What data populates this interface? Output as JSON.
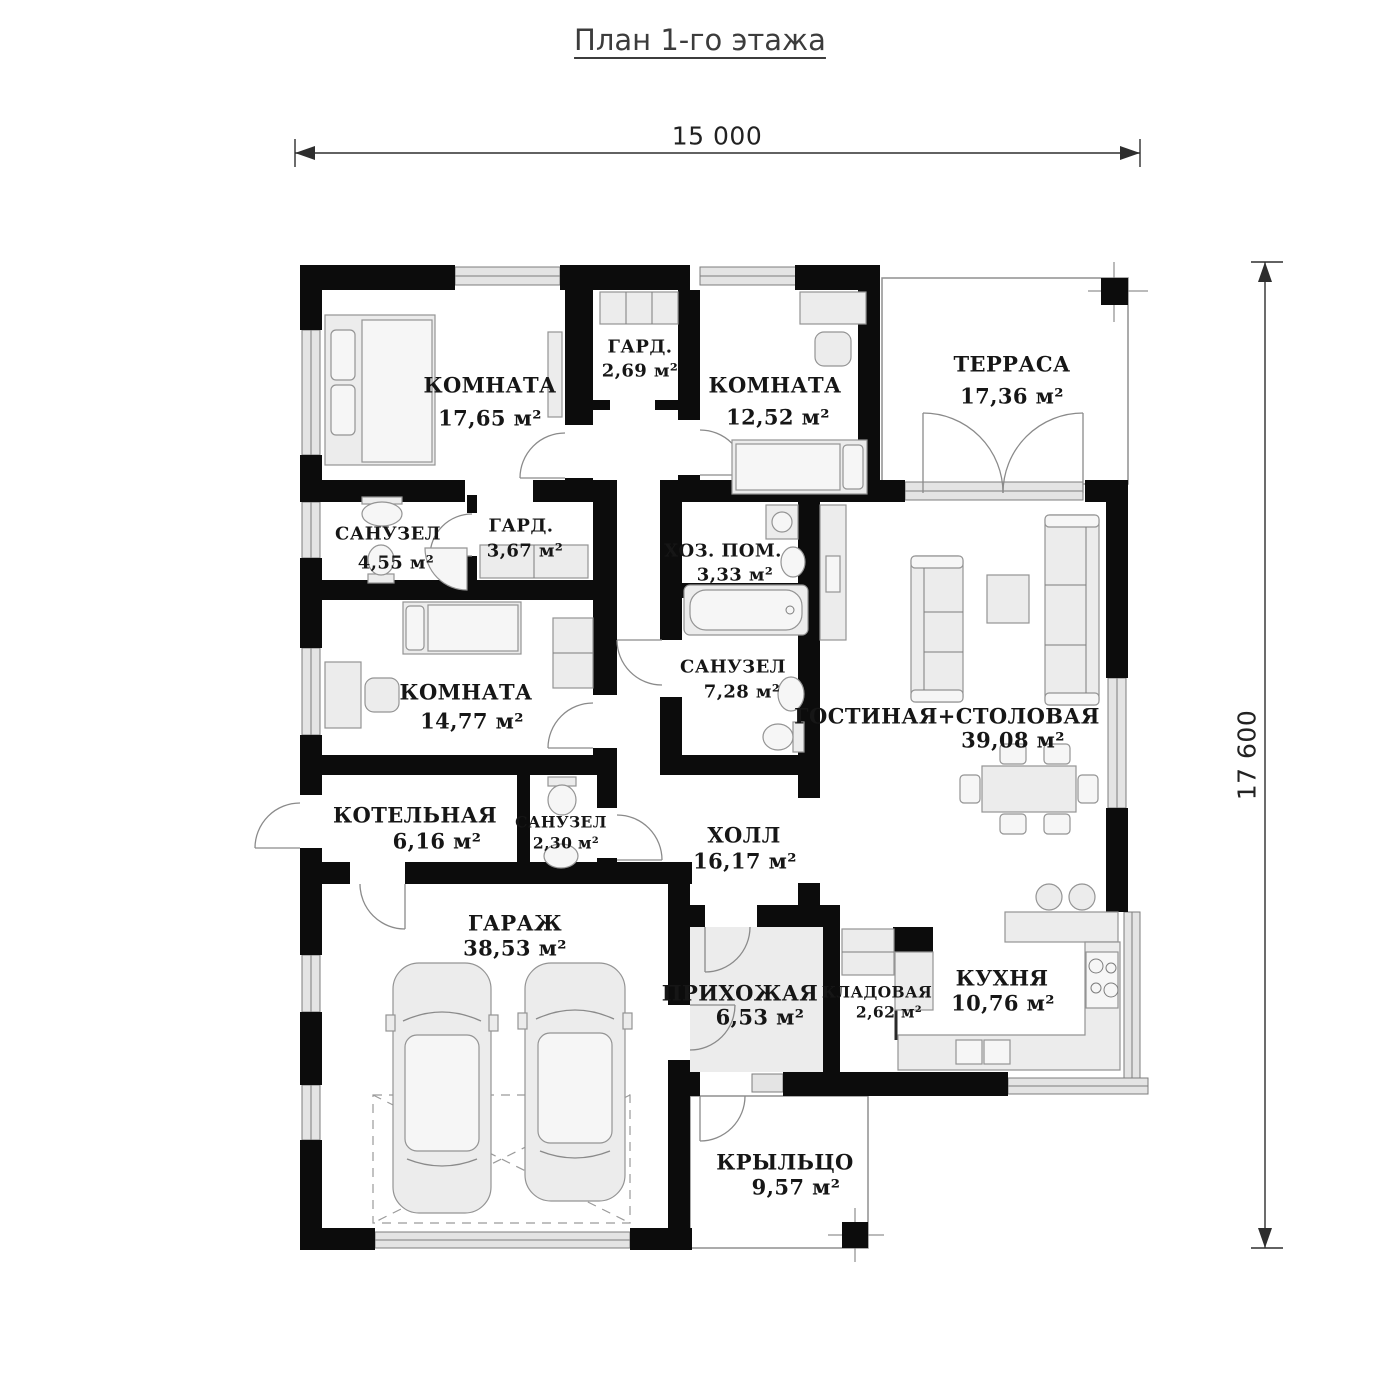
{
  "title": "План 1-го этажа",
  "dimensions": {
    "width": "15 000",
    "height": "17 600"
  },
  "rooms": [
    {
      "name": "КОМНАТА",
      "area": "17,65 м²"
    },
    {
      "name": "ГАРД.",
      "area": "2,69 м²"
    },
    {
      "name": "КОМНАТА",
      "area": "12,52 м²"
    },
    {
      "name": "ТЕРРАСА",
      "area": "17,36 м²"
    },
    {
      "name": "САНУЗЕЛ",
      "area": "4,55 м²"
    },
    {
      "name": "ГАРД.",
      "area": "3,67 м²"
    },
    {
      "name": "ХОЗ. ПОМ.",
      "area": "3,33 м²"
    },
    {
      "name": "САНУЗЕЛ",
      "area": "7,28 м²"
    },
    {
      "name": "КОМНАТА",
      "area": "14,77 м²"
    },
    {
      "name": "ГОСТИНАЯ+СТОЛОВАЯ",
      "area": "39,08 м²"
    },
    {
      "name": "КОТЕЛЬНАЯ",
      "area": "6,16 м²"
    },
    {
      "name": "САНУЗЕЛ",
      "area": "2,30 м²"
    },
    {
      "name": "ХОЛЛ",
      "area": "16,17 м²"
    },
    {
      "name": "ГАРАЖ",
      "area": "38,53 м²"
    },
    {
      "name": "ПРИХОЖАЯ",
      "area": "6,53 м²"
    },
    {
      "name": "КЛАДОВАЯ",
      "area": "2,62 м²"
    },
    {
      "name": "КУХНЯ",
      "area": "10,76 м²"
    },
    {
      "name": "КРЫЛЬЦО",
      "area": "9,57 м²"
    }
  ]
}
